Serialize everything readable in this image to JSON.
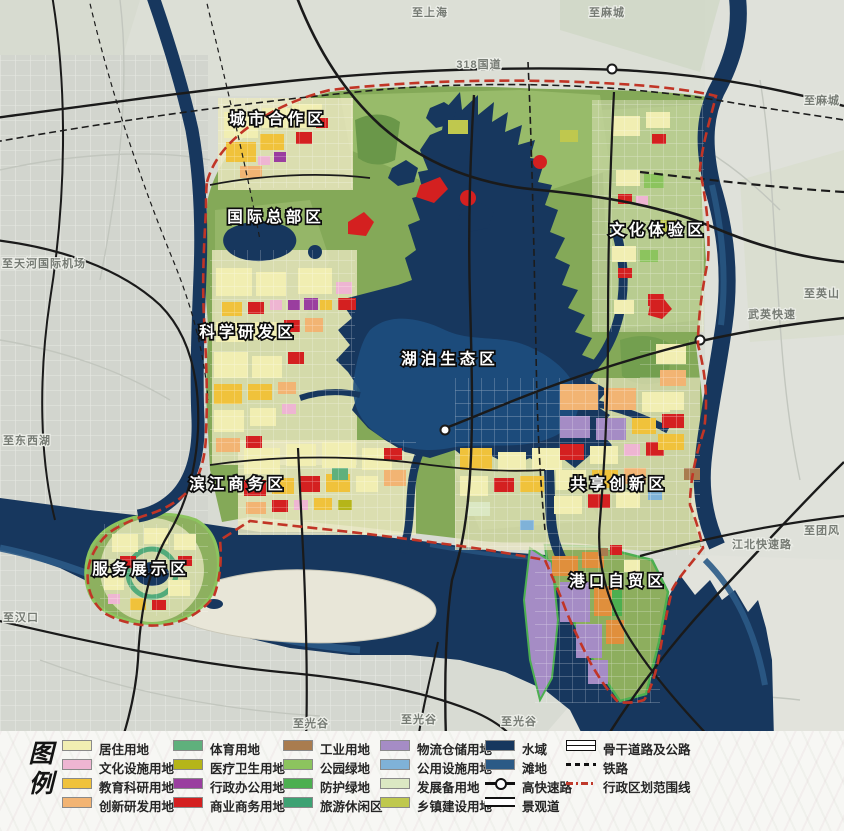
{
  "legend": {
    "title_char1": "图",
    "title_char2": "例",
    "columns": [
      {
        "x": 62,
        "items": [
          {
            "type": "swatch",
            "label": "居住用地",
            "color": "#f1eeb2"
          },
          {
            "type": "swatch",
            "label": "文化设施用地",
            "color": "#eeb5d2"
          },
          {
            "type": "swatch",
            "label": "教育科研用地",
            "color": "#f0c23b"
          },
          {
            "type": "swatch",
            "label": "创新研发用地",
            "color": "#f2b473"
          }
        ]
      },
      {
        "x": 173,
        "items": [
          {
            "type": "swatch",
            "label": "体育用地",
            "color": "#5fb07c"
          },
          {
            "type": "swatch",
            "label": "医疗卫生用地",
            "color": "#b5b519"
          },
          {
            "type": "swatch",
            "label": "行政办公用地",
            "color": "#9a3e9f"
          },
          {
            "type": "swatch",
            "label": "商业商务用地",
            "color": "#d42020"
          }
        ]
      },
      {
        "x": 283,
        "items": [
          {
            "type": "swatch",
            "label": "工业用地",
            "color": "#a97c4f"
          },
          {
            "type": "swatch",
            "label": "公园绿地",
            "color": "#8cc45e"
          },
          {
            "type": "swatch",
            "label": "防护绿地",
            "color": "#4caf50"
          },
          {
            "type": "swatch",
            "label": "旅游休闲区",
            "color": "#3da273"
          }
        ]
      },
      {
        "x": 380,
        "items": [
          {
            "type": "swatch",
            "label": "物流仓储用地",
            "color": "#a58cc5"
          },
          {
            "type": "swatch",
            "label": "公用设施用地",
            "color": "#7fb2d8"
          },
          {
            "type": "swatch",
            "label": "发展备用地",
            "color": "#dbe8c3"
          },
          {
            "type": "swatch",
            "label": "乡镇建设用地",
            "color": "#bfc84e"
          }
        ]
      },
      {
        "x": 485,
        "items": [
          {
            "type": "swatch",
            "label": "水域",
            "color": "#17375e"
          },
          {
            "type": "swatch",
            "label": "滩地",
            "color": "#2b5a86"
          },
          {
            "type": "symbol",
            "label": "高快速路",
            "symbol": "expressway"
          },
          {
            "type": "symbol",
            "label": "景观道",
            "symbol": "scenic"
          }
        ]
      },
      {
        "x": 566,
        "items": [
          {
            "type": "symbol",
            "label": "骨干道路及公路",
            "symbol": "trunk"
          },
          {
            "type": "symbol",
            "label": "铁路",
            "symbol": "rail"
          },
          {
            "type": "symbol",
            "label": "行政区划范围线",
            "symbol": "admin"
          }
        ]
      }
    ]
  },
  "map_labels": {
    "districts": [
      {
        "text": "城市合作区",
        "x": 278,
        "y": 124
      },
      {
        "text": "国际总部区",
        "x": 276,
        "y": 222
      },
      {
        "text": "科学研发区",
        "x": 248,
        "y": 337
      },
      {
        "text": "湖泊生态区",
        "x": 450,
        "y": 364
      },
      {
        "text": "文化体验区",
        "x": 658,
        "y": 235
      },
      {
        "text": "共享创新区",
        "x": 619,
        "y": 489
      },
      {
        "text": "滨江商务区",
        "x": 238,
        "y": 489
      },
      {
        "text": "服务展示区",
        "x": 141,
        "y": 574
      },
      {
        "text": "港口自贸区",
        "x": 618,
        "y": 586
      }
    ],
    "places": [
      {
        "text": "至上海",
        "x": 430,
        "y": 16
      },
      {
        "text": "至麻城",
        "x": 607,
        "y": 16
      },
      {
        "text": "318国道",
        "x": 479,
        "y": 68
      },
      {
        "text": "至麻城",
        "x": 822,
        "y": 104
      },
      {
        "text": "至英山",
        "x": 822,
        "y": 297
      },
      {
        "text": "武英快速",
        "x": 772,
        "y": 318
      },
      {
        "text": "至团风",
        "x": 822,
        "y": 534
      },
      {
        "text": "江北快速路",
        "x": 762,
        "y": 548
      },
      {
        "text": "至天河国际机场",
        "x": 44,
        "y": 267
      },
      {
        "text": "至东西湖",
        "x": 27,
        "y": 444
      },
      {
        "text": "至汉口",
        "x": 21,
        "y": 621
      },
      {
        "text": "至光谷",
        "x": 311,
        "y": 727
      },
      {
        "text": "至光谷",
        "x": 419,
        "y": 723
      },
      {
        "text": "至光谷",
        "x": 519,
        "y": 725
      }
    ]
  },
  "colors": {
    "water": "#17375e",
    "shoal": "#2b5a86",
    "boundary": "#c13526",
    "planning_green": "#84a958"
  }
}
